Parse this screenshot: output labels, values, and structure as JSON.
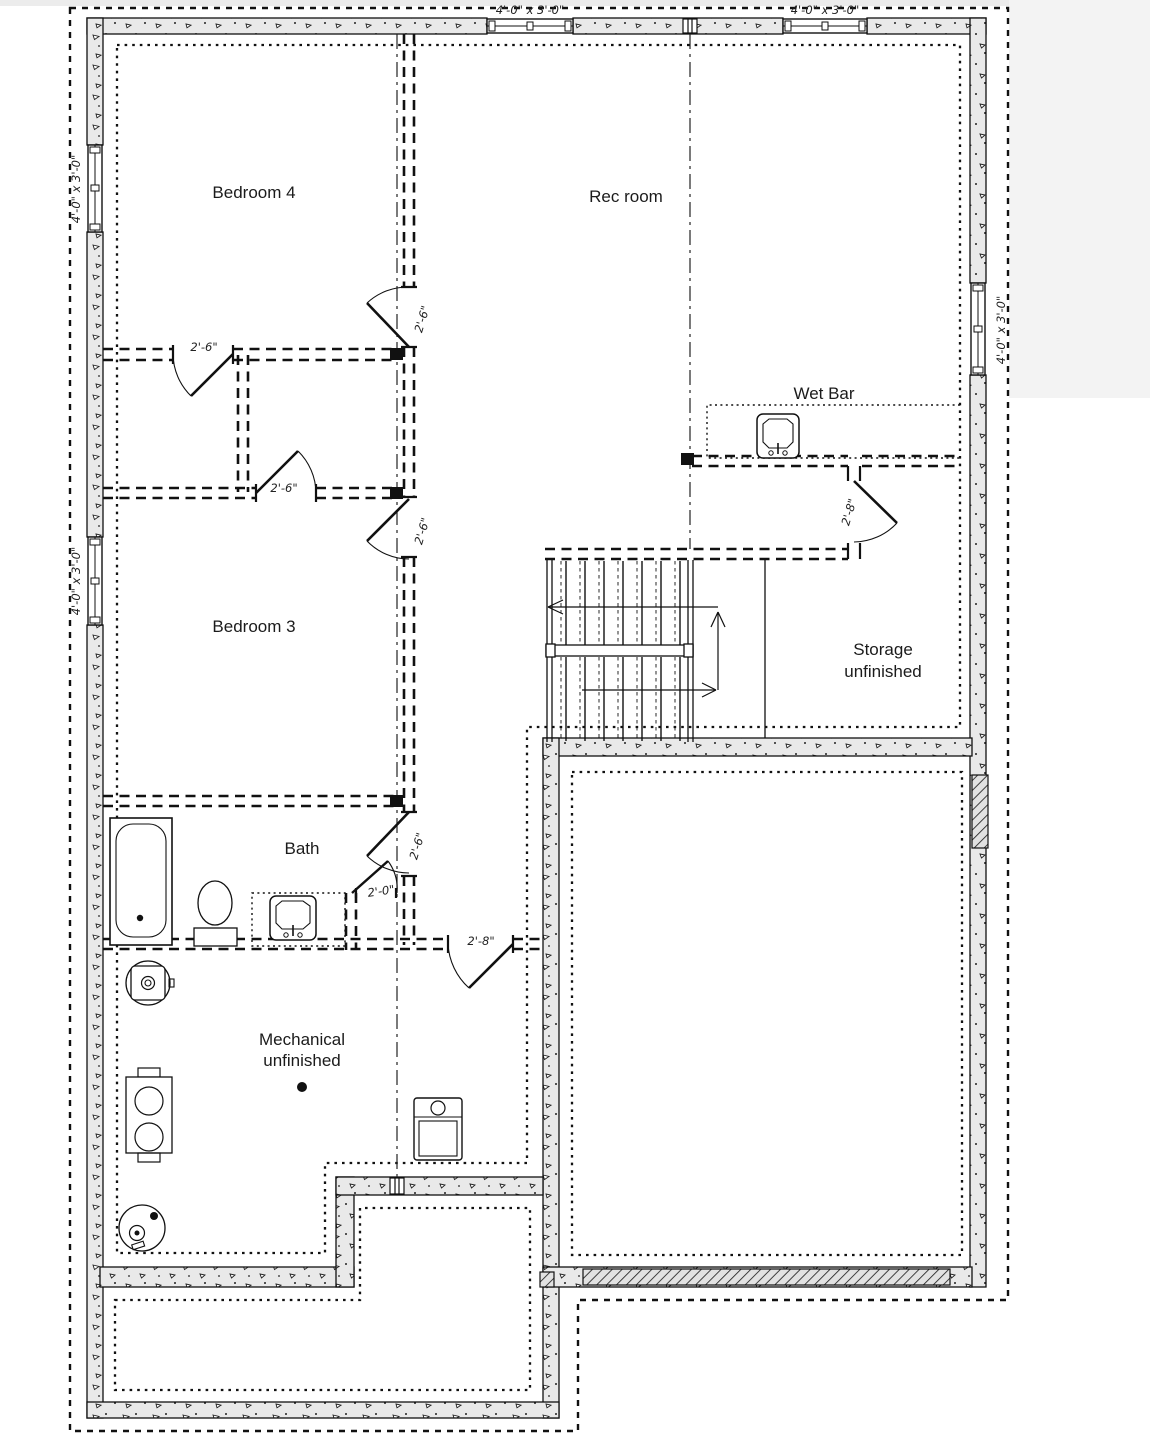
{
  "page": {
    "background": "#ffffff",
    "margin_color": "#f3f3f3",
    "line_color": "#111111",
    "concrete_fill": "#e9e9e9"
  },
  "plan": {
    "rooms": [
      {
        "name": "bedroom-4",
        "label": "Bedroom 4"
      },
      {
        "name": "rec-room",
        "label": "Rec room"
      },
      {
        "name": "wet-bar",
        "label": "Wet Bar"
      },
      {
        "name": "bedroom-3",
        "label": "Bedroom 3"
      },
      {
        "name": "storage",
        "label": "Storage",
        "sublabel": "unfinished"
      },
      {
        "name": "bath",
        "label": "Bath"
      },
      {
        "name": "mechanical",
        "label": "Mechanical",
        "sublabel": "unfinished"
      }
    ],
    "doors": [
      {
        "name": "bedroom4-closet-door",
        "size": "2'-6\""
      },
      {
        "name": "bedroom3-closet-door",
        "size": "2'-6\""
      },
      {
        "name": "bedroom4-entry-door",
        "size": "2'-6\""
      },
      {
        "name": "bedroom3-entry-door",
        "size": "2'-6\""
      },
      {
        "name": "bath-entry-door",
        "size": "2'-6\""
      },
      {
        "name": "linen-closet-door",
        "size": "2'-0\""
      },
      {
        "name": "mechanical-door",
        "size": "2'-8\""
      },
      {
        "name": "storage-door",
        "size": "2'-8\""
      }
    ],
    "windows": [
      {
        "name": "top-wall-window-left",
        "size": "4'-0\" x 3'-0\""
      },
      {
        "name": "top-wall-window-right",
        "size": "4'-0\" x 3'-0\""
      },
      {
        "name": "left-wall-window-upper",
        "size": "4'-0\" x 3'-0\""
      },
      {
        "name": "left-wall-window-lower",
        "size": "4'-0\" x 3'-0\""
      },
      {
        "name": "right-wall-window",
        "size": "4'-0\" x 3'-0\""
      }
    ]
  }
}
